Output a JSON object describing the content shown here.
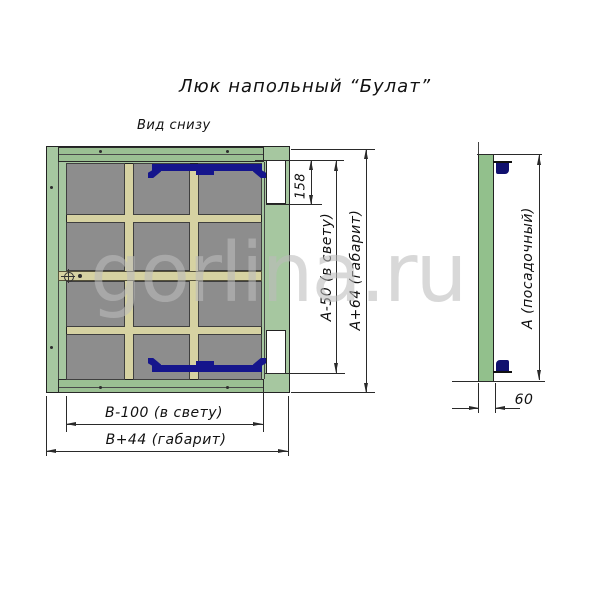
{
  "title": "Люк напольный “Булат”",
  "main_view": {
    "label": "Вид снизу",
    "dims": {
      "cutout": "158",
      "height_clear": "А-50 (в свету)",
      "height_overall": "А+64 (габарит)",
      "width_clear": "В-100 (в свету)",
      "width_overall": "В+44 (габарит)"
    }
  },
  "side_view": {
    "dims": {
      "seat_height": "А (посадочный)",
      "thickness": "60"
    }
  },
  "watermark": "gorlina.ru",
  "colors": {
    "frame_green": "#a6c7a0",
    "rail_green": "#9bc093",
    "panel_gray": "#8d8d8d",
    "stiffener_khaki": "#d6d2a2",
    "hinge_navy": "#15158c",
    "side_bar_green": "#92c08c",
    "cutout_white": "#ffffff"
  }
}
